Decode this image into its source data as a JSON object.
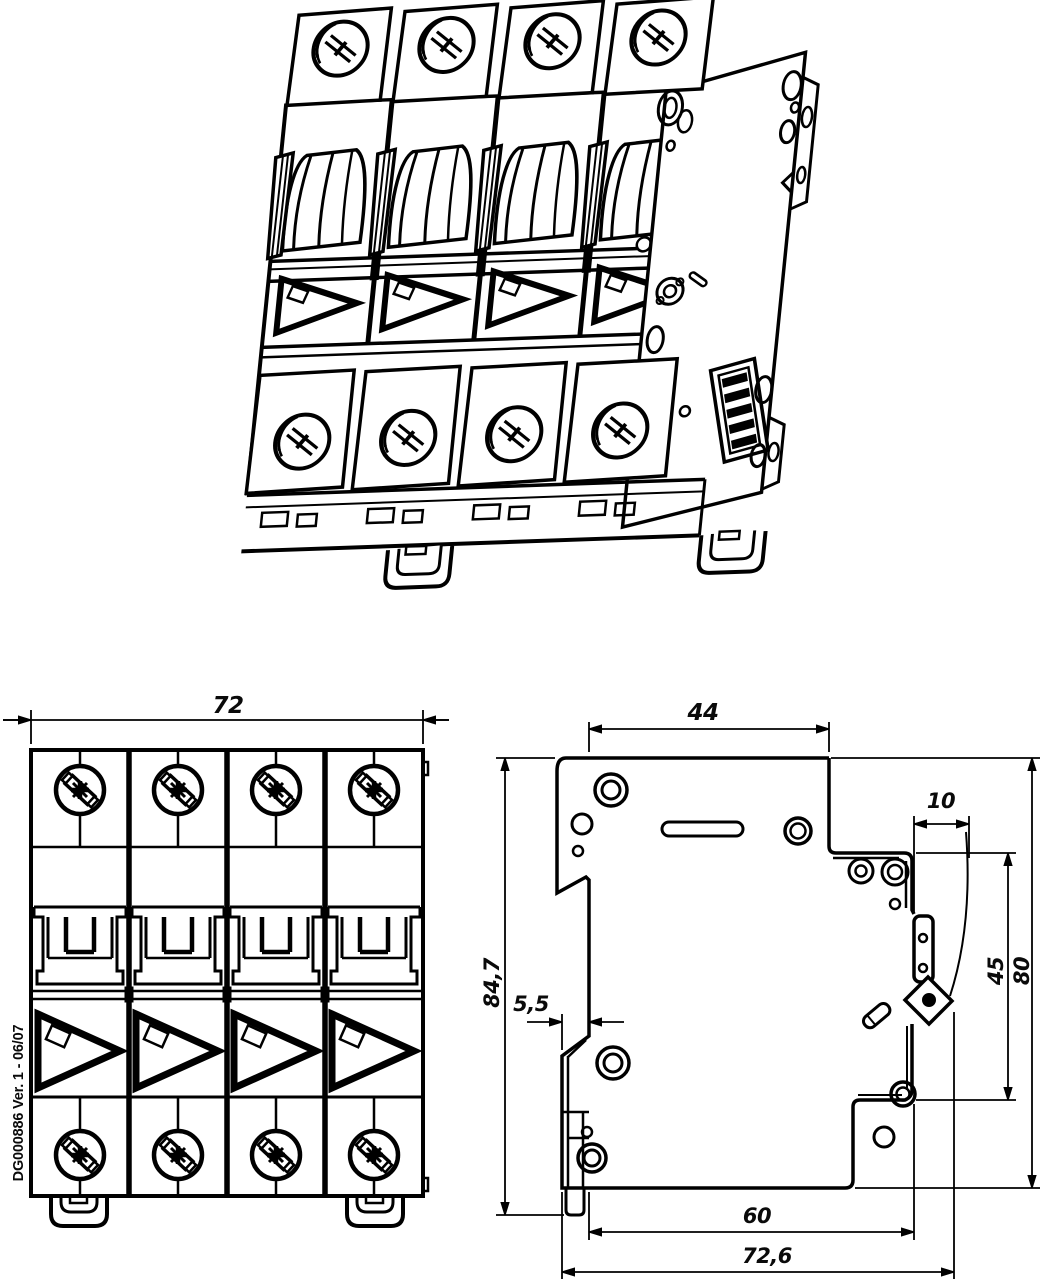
{
  "title": "Technical drawing - 4-pole DIN-rail miniature circuit breaker",
  "colors": {
    "background": "#ffffff",
    "line": "#000000"
  },
  "part_label": "DG000886 Ver. 1 - 06/07",
  "views": {
    "isometric": "isometric projection",
    "front": "front elevation",
    "side": "side elevation"
  },
  "dimensions": {
    "front_width": "72",
    "side_top_depth": "44",
    "side_latch_offset": "10",
    "side_recess_height": "45",
    "side_body_height": "80",
    "side_overall_height": "84,7",
    "side_hook_offset": "5,5",
    "side_body_depth": "60",
    "side_overall_depth": "72,6"
  }
}
